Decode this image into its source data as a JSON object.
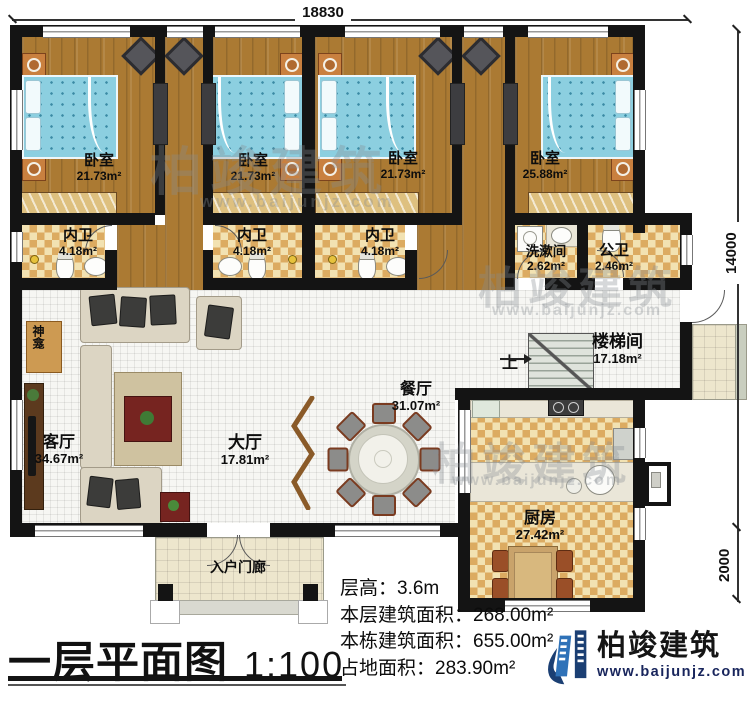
{
  "title": {
    "text": "一层平面图",
    "scale": "1:100"
  },
  "dimensions": {
    "width": "18830",
    "height_main": "14000",
    "height_ext": "2000"
  },
  "rooms": {
    "bedroom1": {
      "name": "卧室",
      "area": "21.73m²"
    },
    "bedroom2": {
      "name": "卧室",
      "area": "21.73m²"
    },
    "bedroom3": {
      "name": "卧室",
      "area": "21.73m²"
    },
    "bedroom4": {
      "name": "卧室",
      "area": "25.88m²"
    },
    "bath1": {
      "name": "内卫",
      "area": "4.18m²"
    },
    "bath2": {
      "name": "内卫",
      "area": "4.18m²"
    },
    "bath3": {
      "name": "内卫",
      "area": "4.18m²"
    },
    "washroom": {
      "name": "洗漱间",
      "area": "2.62m²"
    },
    "public_bath": {
      "name": "公卫",
      "area": "2.46m²"
    },
    "stairwell": {
      "name": "楼梯间",
      "area": "17.18m²"
    },
    "dining": {
      "name": "餐厅",
      "area": "31.07m²"
    },
    "hall": {
      "name": "大厅",
      "area": "17.81m²"
    },
    "living": {
      "name": "客厅",
      "area": "34.67m²"
    },
    "kitchen": {
      "name": "厨房",
      "area": "27.42m²"
    },
    "porch": {
      "name": "入户门廊"
    },
    "shrine": {
      "name": "神龛"
    },
    "stairs_up": "上"
  },
  "info": {
    "floor_height": "层高：3.6m",
    "floor_area": "本层建筑面积：268.00m²",
    "building_area": "本栋建筑面积：655.00m²",
    "footprint": "占地面积：283.90m²"
  },
  "branding": {
    "company": "柏竣建筑",
    "website": "www.baijunjz.com"
  },
  "colors": {
    "wall": "#141414",
    "wood_floor": "#ab7a33",
    "tile_checker": "#dcab61",
    "bed_blue": "#8ccfe0",
    "brand_blue": "#2f72b8",
    "brand_navy": "#1b3f73"
  }
}
